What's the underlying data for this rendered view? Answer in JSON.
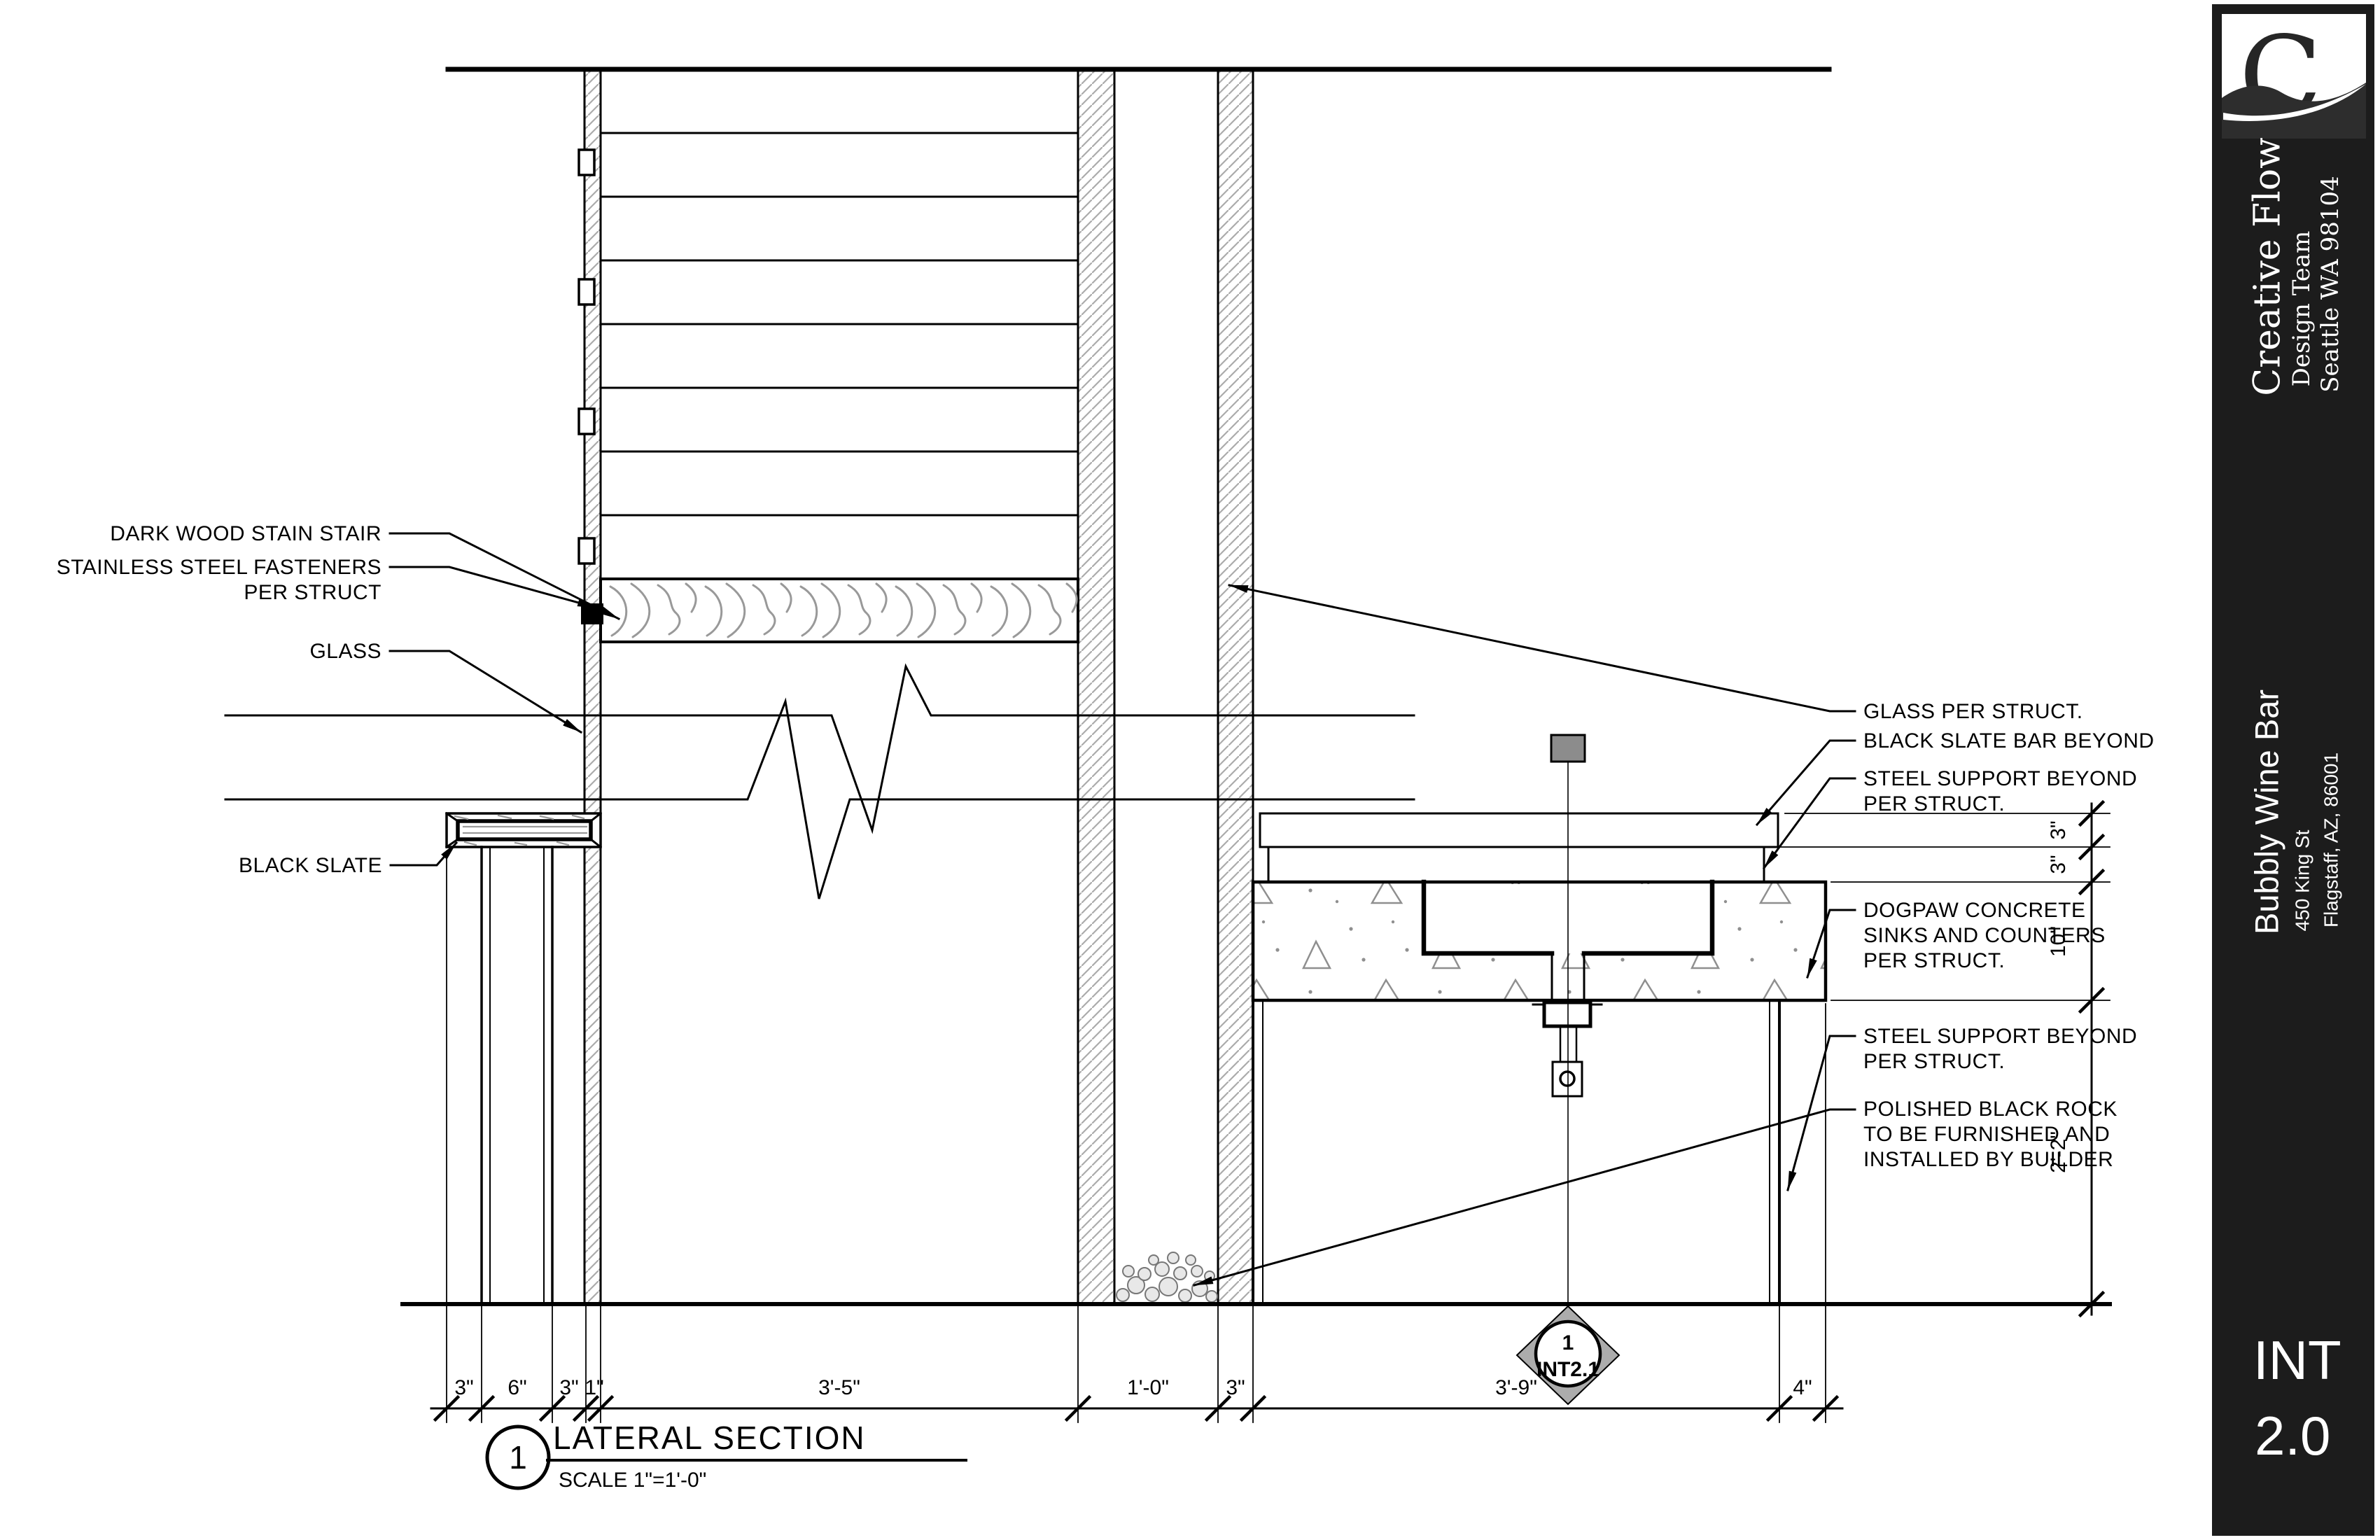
{
  "drawing": {
    "left_labels": {
      "stair": "DARK WOOD STAIN STAIR",
      "fasteners_line1": "STAINLESS STEEL FASTENERS",
      "fasteners_line2": "PER STRUCT",
      "glass": "GLASS",
      "black_slate": "BLACK SLATE"
    },
    "right_labels": {
      "glass": "GLASS PER STRUCT.",
      "slate_bar": "BLACK SLATE BAR BEYOND",
      "steel_upper_line1": "STEEL SUPPORT BEYOND",
      "steel_upper_line2": "PER STRUCT.",
      "concrete_line1": "DOGPAW CONCRETE",
      "concrete_line2": "SINKS AND COUNTERS",
      "concrete_line3": "PER STRUCT.",
      "steel_lower_line1": "STEEL SUPPORT BEYOND",
      "steel_lower_line2": "PER STRUCT.",
      "rock_line1": "POLISHED BLACK ROCK",
      "rock_line2": "TO BE FURNISHED AND",
      "rock_line3": "INSTALLED BY BUILDER"
    },
    "dims_bottom": [
      "3\"",
      "6\"",
      "3\"",
      "1\"",
      "3'-5\"",
      "1'-0\"",
      "3\"",
      "3'-9\"",
      "4\""
    ],
    "dims_right": [
      "3\"",
      "3\"",
      "10\"",
      "2'-2\""
    ],
    "view_title": {
      "number": "1",
      "title": "LATERAL SECTION",
      "scale": "SCALE 1\"=1'-0\""
    },
    "detail_marker": {
      "number": "1",
      "sheet": "INT2.1"
    }
  },
  "title_block": {
    "logo_letter": "C",
    "firm_name": "Creative Flow",
    "firm_team": "Design Team",
    "firm_address": "Seattle WA 98104",
    "project_name": "Bubbly Wine Bar",
    "project_address_line1": "450 King St",
    "project_address_line2": "Flagstaff, AZ, 86001",
    "sheet_number_line1": "INT",
    "sheet_number_line2": "2.0"
  },
  "colors": {
    "ink": "#000000",
    "panel": "#1c1c1c",
    "panel_text": "#ffffff",
    "hatch_gray": "#ababab",
    "concrete_gray": "#8f8f8f",
    "steel_gray": "#8c8c8c",
    "marker_gray": "#acacac"
  }
}
